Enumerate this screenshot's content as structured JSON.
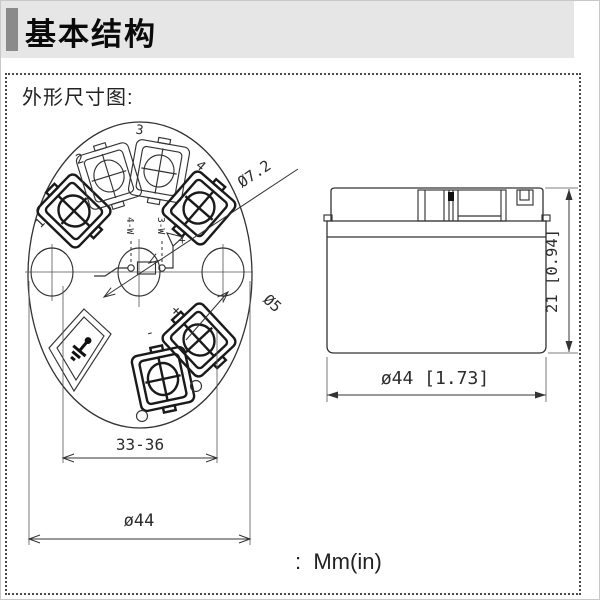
{
  "header": {
    "title": "基本结构"
  },
  "panel": {
    "title": "外形尺寸图:"
  },
  "top_view": {
    "terminal_labels": [
      "1",
      "2",
      "3",
      "4"
    ],
    "wiring": {
      "four_wire": "4-W",
      "three_wire": "3-W"
    },
    "schematic": {
      "minus": "-",
      "plus": "+"
    },
    "terminal_polarity": {
      "minus": "-",
      "plus": "+"
    },
    "dims": {
      "terminal_hole_dia": "Ø7.2",
      "pin_hole_dia": "Ø5",
      "mounting_span": "33-36",
      "outer_dia": "ø44"
    }
  },
  "side_view": {
    "dims": {
      "height": "21 [0.94]",
      "outer_dia": "ø44 [1.73]"
    }
  },
  "footer": {
    "units_label": ":  Mm(in)"
  },
  "colors": {
    "header_bg": "#e6e6e6",
    "header_bar": "#8a8a8a",
    "line": "#333333"
  }
}
